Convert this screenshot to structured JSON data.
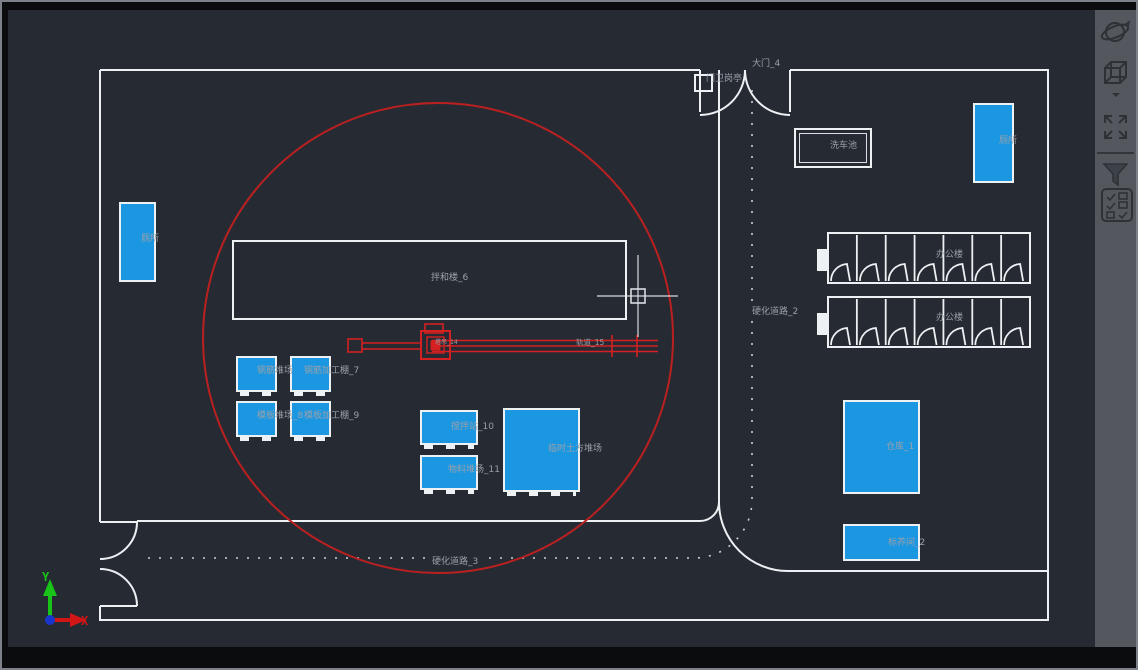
{
  "app": {
    "type": "cad-site-plan-viewer"
  },
  "colors": {
    "canvas_bg": "#262b33",
    "line_white": "#eef1f3",
    "entity_blue": "#1b97e2",
    "crane_red": "#d42020",
    "radius_circle_red": "#bb2020",
    "label_gray": "#99a0a8",
    "toolbar_bg": "#54585e"
  },
  "drawing": {
    "labels": {
      "gate": "大门_4",
      "guard_booth": "门卫岗亭",
      "wash_pool": "洗车池",
      "toilet_left": "厕所",
      "toilet_right": "厕所",
      "mixing_hall": "拌和楼_6",
      "road_vertical": "硬化道路_2",
      "road_horizontal": "硬化道路_3",
      "tower_crane": "塔吊_14",
      "crane_track": "轨道_15",
      "office_1": "办公楼",
      "office_2": "办公楼",
      "rebar_yard": "钢筋堆场",
      "rebar_shed": "钢筋加工棚_7",
      "formwork_yard": "模板堆场_8",
      "formwork_shed": "模板加工棚_9",
      "mixer_station": "搅拌站_10",
      "material_yard": "物料堆场_11",
      "temp_soil_yard": "临时土方堆场",
      "warehouse": "仓库_1",
      "curing_room": "标养间_2"
    },
    "ucs": {
      "x_label": "X",
      "y_label": "Y"
    },
    "offices": {
      "cells": 7,
      "count": 2
    }
  },
  "toolbar": {
    "icons": [
      {
        "name": "orbit-icon"
      },
      {
        "name": "viewcube-icon"
      },
      {
        "name": "expand-arrows-icon"
      },
      {
        "name": "filter-icon"
      },
      {
        "name": "checklist-icon"
      }
    ]
  }
}
